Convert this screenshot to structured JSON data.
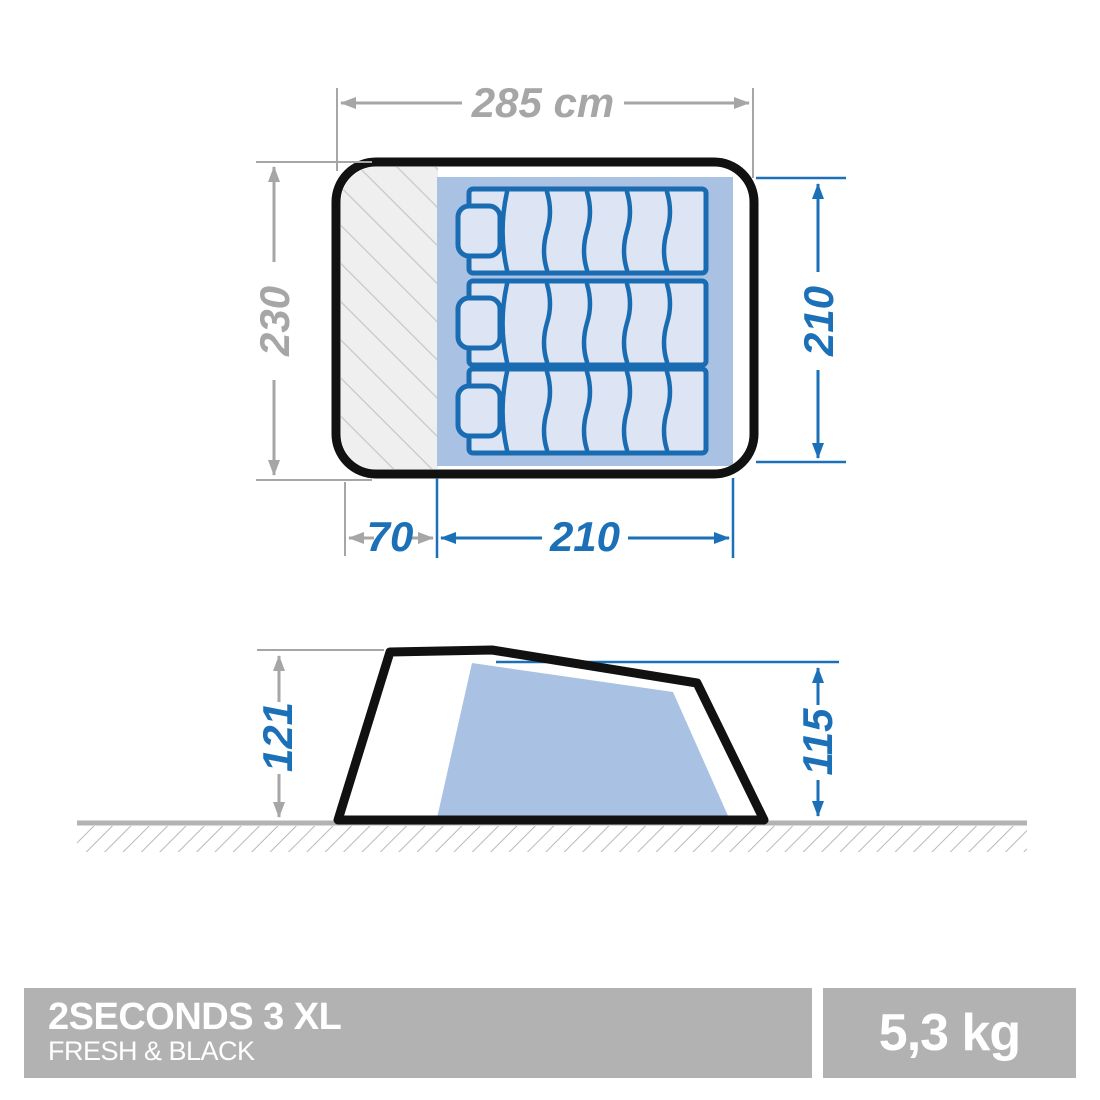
{
  "product": {
    "name": "2SECONDS 3 XL",
    "collection": "FRESH & BLACK",
    "weight": "5,3 kg"
  },
  "top_view": {
    "outer_width_cm": "285 cm",
    "outer_depth_cm": "230",
    "bedroom_length_cm": "210",
    "vestibule_depth_cm": "70",
    "bedroom_width_cm": "210",
    "sleeping_pad_count": 3
  },
  "side_view": {
    "outer_height_cm": "121",
    "inner_height_cm": "115"
  },
  "colors": {
    "dimension_blue": "#1c70b7",
    "dimension_gray": "#a6a6a6",
    "bedroom_fill": "#a9c1e3",
    "sleeping_pad_fill": "#dde4f3",
    "sleeping_pad_stroke": "#1a6cb2",
    "tent_outline": "#111111",
    "vestibule_hatch_line": "#c8c8c8",
    "vestibule_hatch_bg": "#efefef",
    "ground_line": "#b3b3b3",
    "banner_background": "#b2b2b2",
    "banner_text": "#ffffff"
  }
}
